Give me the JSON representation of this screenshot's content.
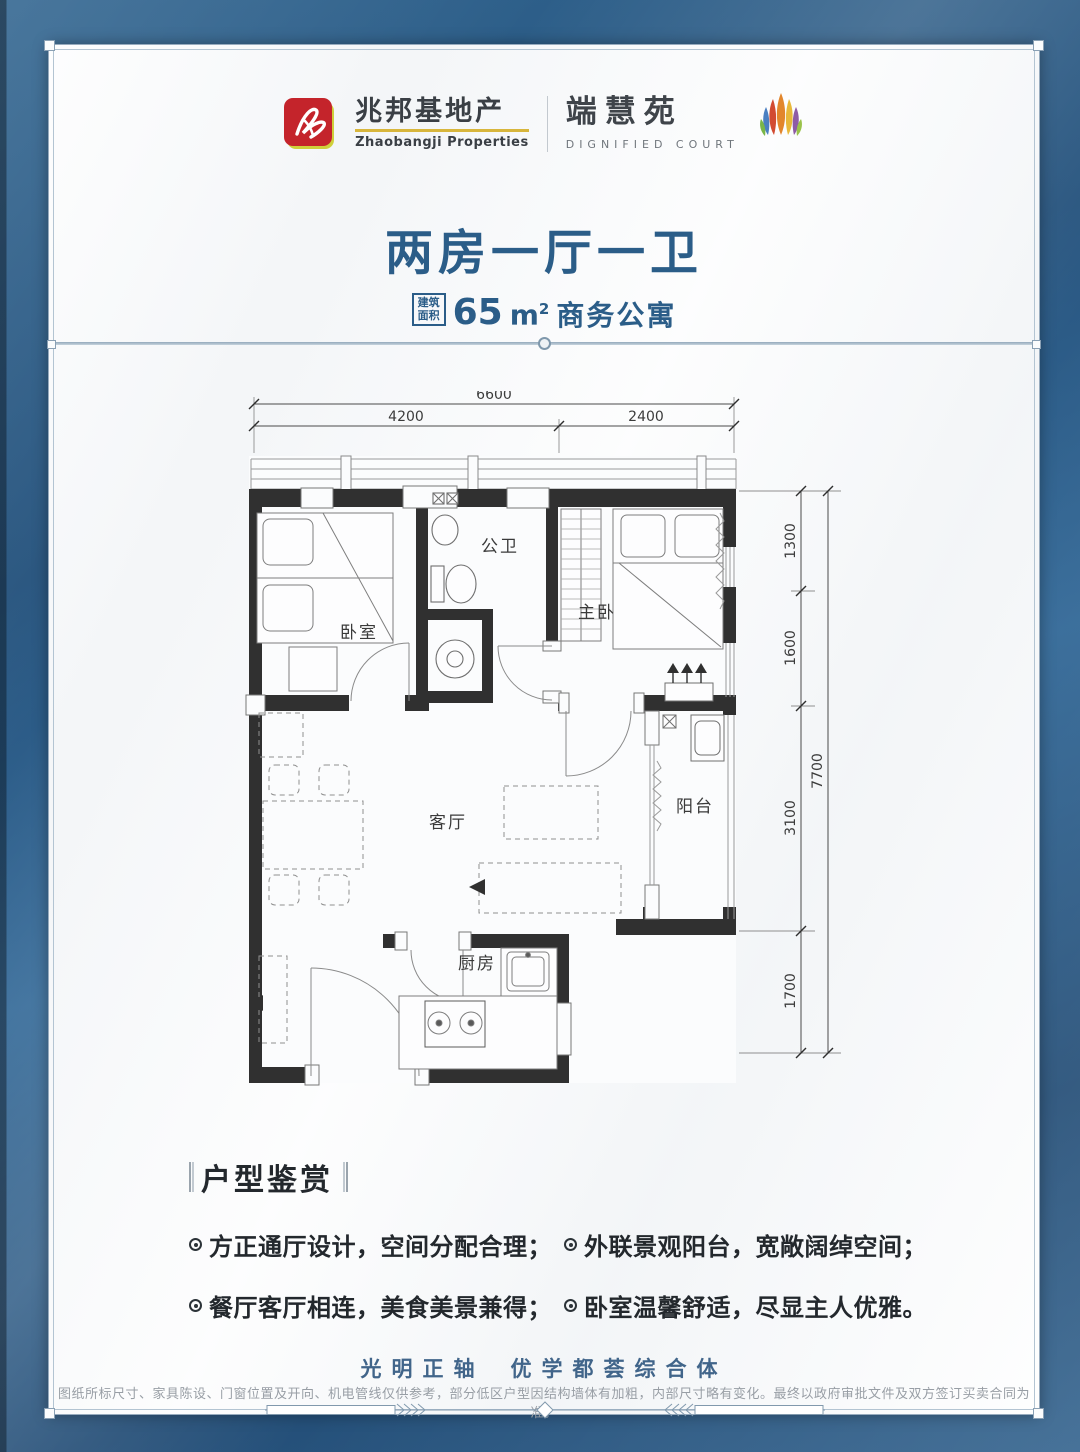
{
  "brand": {
    "developer_name_cn": "兆邦基地产",
    "developer_name_en": "Zhaobangji Properties",
    "project_name_cn": "端慧苑",
    "project_name_en": "DIGNIFIED COURT"
  },
  "headline": {
    "title": "两房一厅一卫",
    "area_label_line1": "建筑",
    "area_label_line2": "面积",
    "area_number": "65",
    "area_unit": "m",
    "area_unit_sup": "2",
    "area_suffix": "商务公寓"
  },
  "floorplan": {
    "rooms": {
      "bedroom": "卧室",
      "bathroom": "公卫",
      "master_bedroom": "主卧",
      "living_room": "客厅",
      "balcony": "阳台",
      "kitchen": "厨房"
    },
    "dimensions": {
      "top_total": "6600",
      "top_left": "4200",
      "top_right": "2400",
      "right_total": "7700",
      "right_segments": [
        "1300",
        "1600",
        "3100",
        "1700"
      ]
    }
  },
  "highlights": {
    "heading": "户型鉴赏",
    "items": [
      "方正通厅设计，空间分配合理；",
      "餐厅客厅相连，美食美景兼得；",
      "外联景观阳台，宽敞阔绰空间；",
      "卧室温馨舒适，尽显主人优雅。"
    ]
  },
  "footer": {
    "slogan_part1": "光明正轴",
    "slogan_part2": "优学都荟综合体",
    "disclaimer": "图纸所标尺寸、家具陈设、门窗位置及开向、机电管线仅供参考，部分低区户型因结构墙体有加粗，内部尺寸略有变化。最终以政府审批文件及双方签订买卖合同为准。"
  },
  "colors": {
    "frame_blue": "#2e5f8b",
    "accent_blue": "#2b5d88",
    "logo_red": "#c4242b",
    "underline_gold": "#d8b63c",
    "wall_dark": "#303030",
    "text_dark": "#23282d",
    "muted_gray": "#989ea5"
  }
}
